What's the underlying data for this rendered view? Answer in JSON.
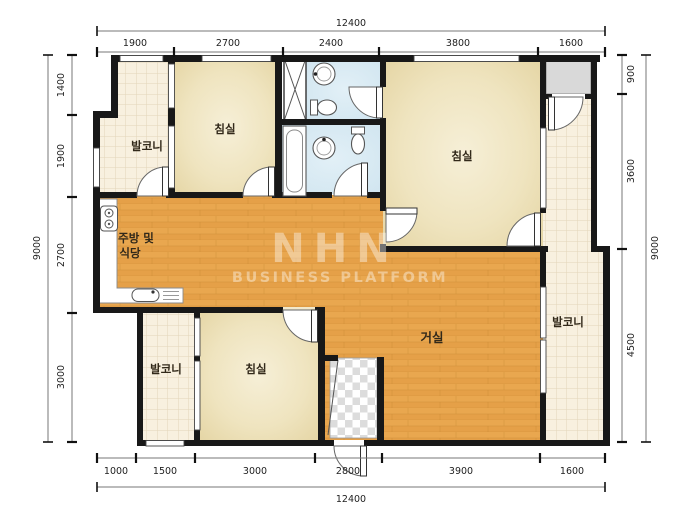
{
  "page": {
    "type": "apartment-floor-plan"
  },
  "watermark": {
    "brand": "NHN",
    "subtitle": "BUSINESS PLATFORM"
  },
  "rooms": {
    "balcony_top_left": "발코니",
    "bedroom_top_left": "침실",
    "bedroom_top_right": "침실",
    "kitchen_line1": "주방 및",
    "kitchen_line2": "식당",
    "living": "거실",
    "balcony_right": "발코니",
    "balcony_bottom_left": "발코니",
    "bedroom_bottom": "침실"
  },
  "dimensions": {
    "top": {
      "total": "12400",
      "segments": [
        "1900",
        "2700",
        "2400",
        "3800",
        "1600"
      ]
    },
    "bottom": {
      "total": "12400",
      "segments": [
        "1000",
        "1500",
        "3000",
        "2800",
        "3900",
        "1600"
      ]
    },
    "left": {
      "total": "9000",
      "segments": [
        "1400",
        "1900",
        "2700",
        "3000"
      ]
    },
    "right": {
      "total": "9000",
      "segments": [
        "900",
        "3600",
        "4500"
      ]
    }
  },
  "colors": {
    "wall": "#181818",
    "wood_floor": "#e8a54e",
    "tile_floor": "#f8f0df",
    "bath_floor": "#d7e9f2",
    "bedroom_floor": "#efe4bf",
    "storage_gray": "#d9d9d9",
    "dim_line": "#666666"
  }
}
